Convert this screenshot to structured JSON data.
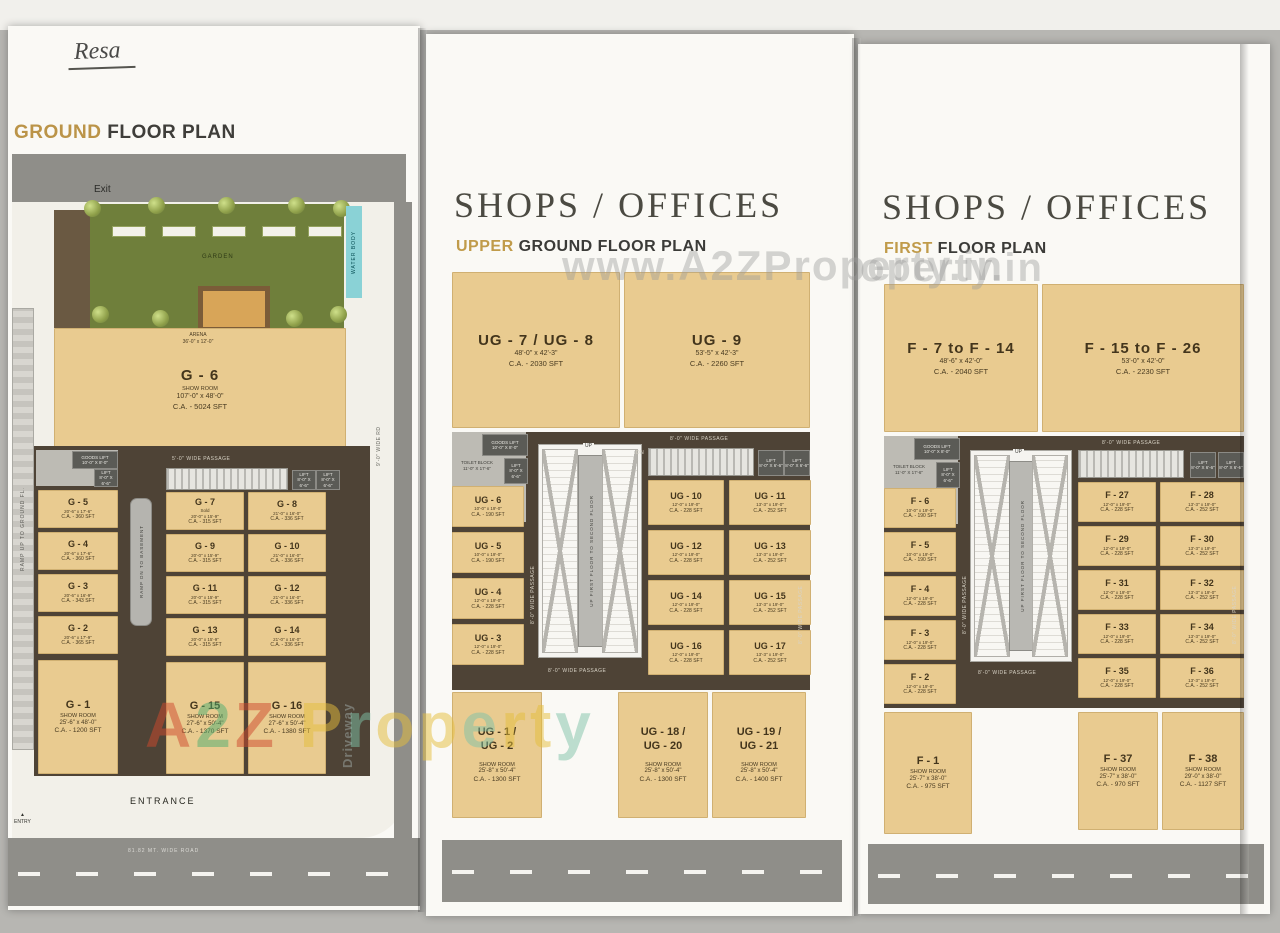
{
  "page": {
    "handwritten_note": "Resa",
    "watermark_mid": "www.A2ZProperty.in",
    "watermark_right": "operty.in",
    "brand_letters": [
      {
        "ch": "A",
        "color": "#cf4a2e"
      },
      {
        "ch": "2",
        "color": "#4fae71"
      },
      {
        "ch": "Z",
        "color": "#cf4a2e"
      },
      {
        "ch": " ",
        "color": "#e5be3c"
      },
      {
        "ch": "P",
        "color": "#e5be3c"
      },
      {
        "ch": "r",
        "color": "#7fc3a8"
      },
      {
        "ch": "o",
        "color": "#e5be3c"
      },
      {
        "ch": "p",
        "color": "#e5be3c"
      },
      {
        "ch": "e",
        "color": "#7fc3a8"
      },
      {
        "ch": "r",
        "color": "#e5be3c"
      },
      {
        "ch": "t",
        "color": "#e5be3c"
      },
      {
        "ch": "y",
        "color": "#7fc3a8"
      }
    ]
  },
  "shared": {
    "shops_offices": "SHOPS / OFFICES",
    "passage": "8'-0\" WIDE PASSAGE",
    "up": "UP",
    "dn": "DN",
    "ramp_text": "UP FIRST FLOOR TO SECOND FLOOR",
    "goods_lift": "GOODS LIFT\n10'-0\" X 8'-0\"",
    "lift": "LIFT\n8'-0\" X 6'-6\"",
    "toilet": "TOILET BLOCK\n11'-0\" X 17'-6\""
  },
  "ground": {
    "title_accent": "GROUND",
    "title_rest": " FLOOR PLAN",
    "labels": {
      "exit": "Exit",
      "garden": "GARDEN",
      "water_body": "WATER BODY",
      "arena": "ARENA\n36'-0\" x 12'-0\"",
      "entrance": "ENTRANCE",
      "entry": "ENTRY",
      "driveway": "Driveway",
      "ramp_left": "RAMP UP TO GROUND FL.",
      "road": "81.82 MT. WIDE ROAD",
      "passage5": "5'-0\" WIDE PASSAGE",
      "basement_ramp": "RAMP DN TO BASEMENT",
      "wide_rd": "9'-0\" WIDE RD"
    },
    "g6": {
      "id": "G - 6",
      "sub": "SHOW ROOM",
      "dims": "107'-0\" x 48'-0\"",
      "area": "C.A. - 5024 SFT"
    },
    "g1": {
      "id": "G - 1",
      "sub": "SHOW ROOM",
      "dims": "25'-6\" x 48'-0\"",
      "area": "C.A. - 1200 SFT"
    },
    "g15": {
      "id": "G - 15",
      "sub": "SHOW ROOM",
      "dims": "27'-6\" x 50'-4\"",
      "area": "C.A. - 1370 SFT"
    },
    "g16": {
      "id": "G - 16",
      "sub": "SHOW ROOM",
      "dims": "27'-6\" x 50'-4\"",
      "area": "C.A. - 1380 SFT"
    },
    "left_units": [
      {
        "id": "G - 5",
        "dims": "20'-6\" x 17'-6\"",
        "area": "C.A. - 360 SFT"
      },
      {
        "id": "G - 4",
        "dims": "20'-6\" x 17'-6\"",
        "area": "C.A. - 360 SFT"
      },
      {
        "id": "G - 3",
        "dims": "20'-6\" x 16'-9\"",
        "area": "C.A. - 343 SFT"
      },
      {
        "id": "G - 2",
        "dims": "20'-6\" x 17'-9\"",
        "area": "C.A. - 365 SFT"
      }
    ],
    "grid_units": [
      {
        "id": "G - 7",
        "sub": "Sold",
        "dims": "20'-0\" x 15'-9\"",
        "area": "C.A. - 315 SFT"
      },
      {
        "id": "G - 8",
        "dims": "21'-0\" x 16'-0\"",
        "area": "C.A. - 336 SFT"
      },
      {
        "id": "G - 9",
        "dims": "20'-0\" x 15'-9\"",
        "area": "C.A. - 315 SFT"
      },
      {
        "id": "G - 10",
        "dims": "21'-0\" x 16'-0\"",
        "area": "C.A. - 336 SFT"
      },
      {
        "id": "G - 11",
        "dims": "20'-0\" x 15'-9\"",
        "area": "C.A. - 315 SFT"
      },
      {
        "id": "G - 12",
        "dims": "21'-0\" x 16'-0\"",
        "area": "C.A. - 336 SFT"
      },
      {
        "id": "G - 13",
        "dims": "20'-0\" x 15'-9\"",
        "area": "C.A. - 315 SFT"
      },
      {
        "id": "G - 14",
        "dims": "21'-0\" x 16'-0\"",
        "area": "C.A. - 336 SFT"
      }
    ]
  },
  "upper": {
    "subtitle_accent": "UPPER",
    "subtitle_rest": " GROUND FLOOR PLAN",
    "top_units": [
      {
        "id": "UG - 7 / UG - 8",
        "dims": "48'-0\" x 42'-3\"",
        "area": "C.A. - 2030 SFT"
      },
      {
        "id": "UG - 9",
        "dims": "53'-5\" x 42'-3\"",
        "area": "C.A. - 2260 SFT"
      }
    ],
    "left_units": [
      {
        "id": "UG - 6",
        "dims": "10'-0\" x 19'-0\"",
        "area": "C.A. - 190 SFT"
      },
      {
        "id": "UG - 5",
        "dims": "10'-0\" x 19'-0\"",
        "area": "C.A. - 190 SFT"
      },
      {
        "id": "UG - 4",
        "dims": "12'-0\" x 19'-0\"",
        "area": "C.A. - 228 SFT"
      },
      {
        "id": "UG - 3",
        "dims": "12'-0\" x 19'-0\"",
        "area": "C.A. - 228 SFT"
      }
    ],
    "grid_units": [
      {
        "id": "UG - 10",
        "dims": "12'-0\" x 19'-0\"",
        "area": "C.A. - 228 SFT"
      },
      {
        "id": "UG - 11",
        "dims": "13'-3\" x 19'-0\"",
        "area": "C.A. - 252 SFT"
      },
      {
        "id": "UG - 12",
        "dims": "12'-0\" x 19'-0\"",
        "area": "C.A. - 228 SFT"
      },
      {
        "id": "UG - 13",
        "dims": "13'-3\" x 19'-0\"",
        "area": "C.A. - 252 SFT"
      },
      {
        "id": "UG - 14",
        "dims": "12'-0\" x 19'-0\"",
        "area": "C.A. - 228 SFT"
      },
      {
        "id": "UG - 15",
        "dims": "13'-3\" x 19'-0\"",
        "area": "C.A. - 252 SFT"
      },
      {
        "id": "UG - 16",
        "dims": "12'-0\" x 19'-0\"",
        "area": "C.A. - 228 SFT"
      },
      {
        "id": "UG - 17",
        "dims": "13'-3\" x 19'-0\"",
        "area": "C.A. - 252 SFT"
      }
    ],
    "bottom_units": [
      {
        "id": "UG - 1 /",
        "id2": "UG - 2",
        "sub": "SHOW ROOM",
        "dims": "25'-8\" x 50'-4\"",
        "area": "C.A. - 1300 SFT"
      },
      {
        "id": "UG - 18 /",
        "id2": "UG - 20",
        "sub": "SHOW ROOM",
        "dims": "25'-8\" x 50'-4\"",
        "area": "C.A. - 1300 SFT"
      },
      {
        "id": "UG - 19 /",
        "id2": "UG - 21",
        "sub": "SHOW ROOM",
        "dims": "25'-8\" x 50'-4\"",
        "area": "C.A. - 1400 SFT"
      }
    ]
  },
  "first": {
    "subtitle_accent": "FIRST",
    "subtitle_rest": " FLOOR PLAN",
    "top_units": [
      {
        "id": "F - 7 to F - 14",
        "dims": "48'-6\" x 42'-0\"",
        "area": "C.A. - 2040 SFT"
      },
      {
        "id": "F - 15 to F - 26",
        "dims": "53'-0\" x 42'-0\"",
        "area": "C.A. - 2230 SFT"
      }
    ],
    "left_units": [
      {
        "id": "F - 6",
        "dims": "10'-0\" x 19'-0\"",
        "area": "C.A. - 190 SFT"
      },
      {
        "id": "F - 5",
        "dims": "10'-0\" x 19'-0\"",
        "area": "C.A. - 190 SFT"
      },
      {
        "id": "F - 4",
        "dims": "12'-0\" x 19'-0\"",
        "area": "C.A. - 228 SFT"
      },
      {
        "id": "F - 3",
        "dims": "12'-0\" x 19'-0\"",
        "area": "C.A. - 228 SFT"
      },
      {
        "id": "F - 2",
        "dims": "12'-0\" x 19'-0\"",
        "area": "C.A. - 228 SFT"
      }
    ],
    "grid_units": [
      {
        "id": "F - 27",
        "dims": "12'-0\" x 19'-0\"",
        "area": "C.A. - 228 SFT"
      },
      {
        "id": "F - 28",
        "dims": "13'-3\" x 19'-0\"",
        "area": "C.A. - 252 SFT"
      },
      {
        "id": "F - 29",
        "dims": "12'-0\" x 19'-0\"",
        "area": "C.A. - 228 SFT"
      },
      {
        "id": "F - 30",
        "dims": "13'-3\" x 19'-0\"",
        "area": "C.A. - 252 SFT"
      },
      {
        "id": "F - 31",
        "dims": "12'-0\" x 19'-0\"",
        "area": "C.A. - 228 SFT"
      },
      {
        "id": "F - 32",
        "dims": "13'-3\" x 19'-0\"",
        "area": "C.A. - 252 SFT"
      },
      {
        "id": "F - 33",
        "dims": "12'-0\" x 19'-0\"",
        "area": "C.A. - 228 SFT"
      },
      {
        "id": "F - 34",
        "dims": "13'-3\" x 19'-0\"",
        "area": "C.A. - 252 SFT"
      },
      {
        "id": "F - 35",
        "dims": "12'-0\" x 19'-0\"",
        "area": "C.A. - 228 SFT"
      },
      {
        "id": "F - 36",
        "dims": "13'-3\" x 19'-0\"",
        "area": "C.A. - 252 SFT"
      }
    ],
    "bottom_units": [
      {
        "id": "F - 1",
        "sub": "SHOW ROOM",
        "dims": "25'-7\" x 38'-0\"",
        "area": "C.A. - 975 SFT"
      },
      {
        "id": "F - 37",
        "sub": "SHOW ROOM",
        "dims": "25'-7\" x 38'-0\"",
        "area": "C.A. - 970 SFT"
      },
      {
        "id": "F - 38",
        "sub": "SHOW ROOM",
        "dims": "29'-0\" x 38'-0\"",
        "area": "C.A. - 1127 SFT"
      }
    ]
  }
}
